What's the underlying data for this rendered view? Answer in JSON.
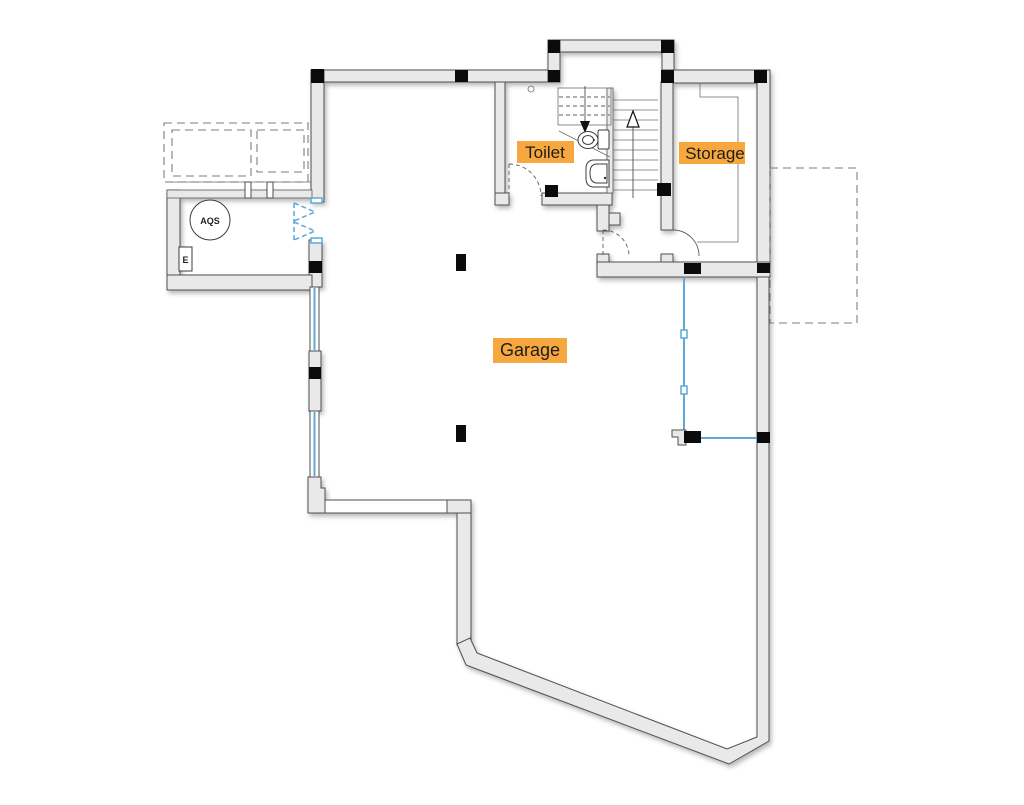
{
  "plan": {
    "type": "floor-plan",
    "level": "garage-level",
    "rooms": [
      {
        "id": "garage",
        "label": "Garage"
      },
      {
        "id": "toilet",
        "label": "Toilet"
      },
      {
        "id": "storage",
        "label": "Storage"
      }
    ],
    "equipment": [
      {
        "id": "aqs-water-heater",
        "label": "AQS"
      },
      {
        "id": "electrical-panel",
        "label": "E"
      }
    ],
    "stairs": {
      "up_arrow": "ascending-run",
      "down_arrow": "descending-run-dashed-above"
    },
    "colors": {
      "wall_fill": "#e9e9e9",
      "wall_stroke": "#4f4f4f",
      "glazing_blue": "#5ea9da",
      "highlight_orange": "#f6a83e",
      "label_text": "#1d1d1d",
      "column_black": "#0b0b0b",
      "dashed_gray": "#7d7d7d",
      "background": "#ffffff"
    }
  }
}
